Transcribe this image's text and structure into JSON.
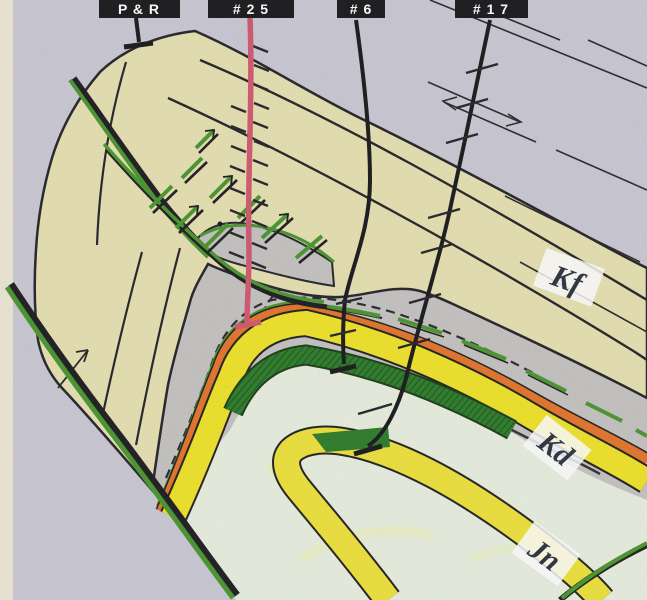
{
  "map": {
    "title": "geologic structure map (scanned, hand-drawn)",
    "wells": [
      {
        "id": "pr",
        "label": "P & R",
        "status": "plugged well symbol (T-bar)"
      },
      {
        "id": "25",
        "label": "# 2 5",
        "status": "red wellbore with hachure ticks, T-bar bottom"
      },
      {
        "id": "6",
        "label": "# 6",
        "status": "black wellbore, T-bar bottom"
      },
      {
        "id": "17",
        "label": "# 1 7",
        "status": "black wellbore with hachure ticks, T-bar bottom"
      }
    ],
    "formations": [
      {
        "code": "Kf",
        "fill": "#e7e1b2",
        "note": "tan band, upper arch"
      },
      {
        "code": "Kd",
        "fill": "#f0e32a",
        "note": "yellow band with orange and dark-green stripes"
      },
      {
        "code": "Jn",
        "fill": "#eee23c",
        "note": "lower yellow hairpin band"
      }
    ],
    "colors": {
      "background": "#cac9d4",
      "paper_edge": "#ece7d5",
      "kf_tan": "#e7e1b2",
      "band_gray": "#c6c3c2",
      "orange_stripe": "#e4762c",
      "kd_yellow": "#f0e32a",
      "dark_green_band": "#2f7d2b",
      "pale_interior": "#e9efdf",
      "fault_green": "#4b9630",
      "well_red": "#d25a70",
      "ink_black": "#26262a",
      "label_box": "#1b1b1d",
      "label_text": "#ffffff",
      "formation_text": "#2e3440"
    }
  }
}
